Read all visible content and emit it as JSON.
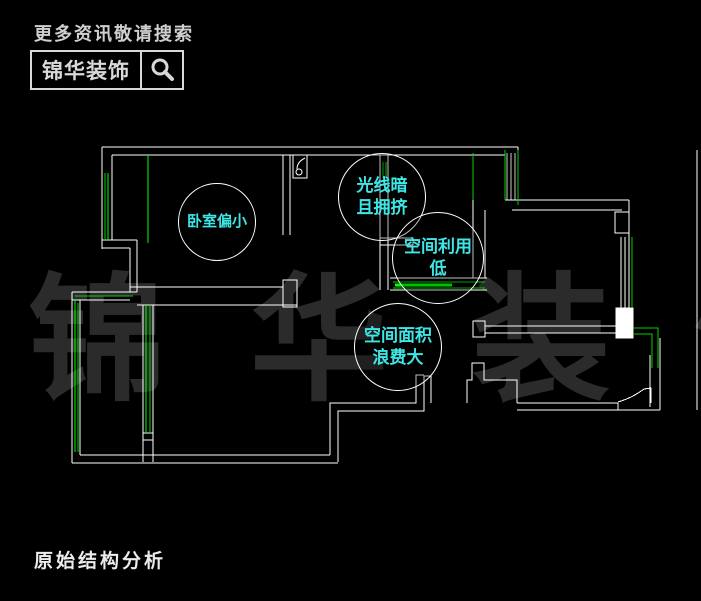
{
  "header": {
    "tagline": "更多资讯敬请搜索",
    "brand": "锦华装饰",
    "search_icon": "magnifier-icon"
  },
  "watermark": {
    "text": "锦 华 装 饰"
  },
  "footer": {
    "title": "原始结构分析"
  },
  "annotations": {
    "bedroom": {
      "line1": "卧室偏小"
    },
    "dark": {
      "line1": "光线暗",
      "line2": "且拥挤"
    },
    "util": {
      "line1": "空间利用",
      "line2": "低"
    },
    "waste": {
      "line1": "空间面积",
      "line2": "浪费大"
    }
  },
  "colors": {
    "background": "#000000",
    "wall_line": "#ffffff",
    "window_green": "#00d200",
    "window_green_bright": "#00ff00",
    "annotation_cyan": "#3fe6e6",
    "watermark_gray": "#2b2b2b",
    "header_gray": "#d9d9d9"
  }
}
